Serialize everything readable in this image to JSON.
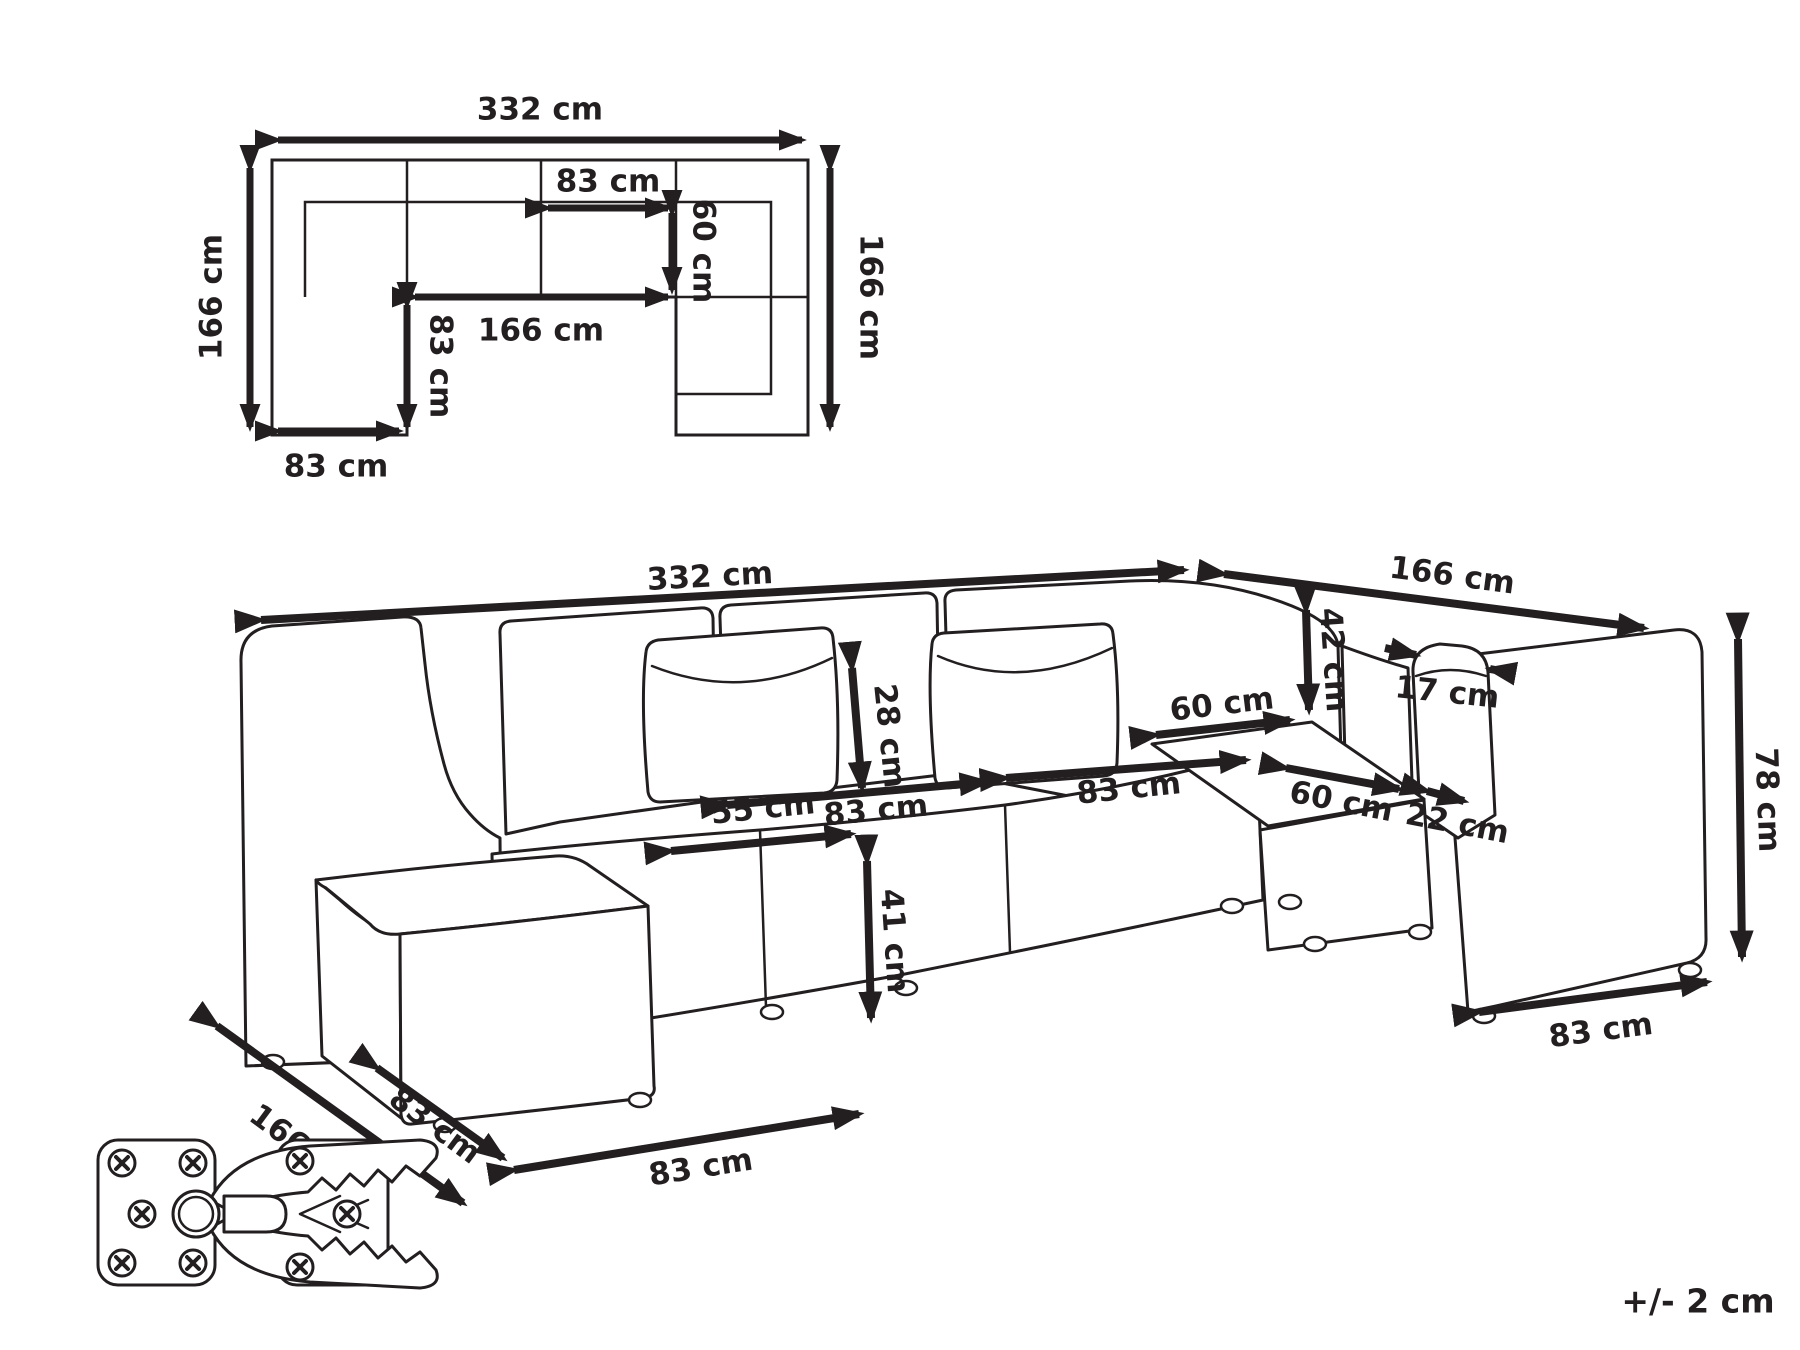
{
  "figure": {
    "type": "modular-corner-sofa-dimension-drawing",
    "line_color": "#231f20",
    "background": "#ffffff",
    "tolerance_note": "+/- 2 cm"
  },
  "plan_view": {
    "dims": {
      "overall_width": "332 cm",
      "left_depth": "166 cm",
      "right_depth": "166 cm",
      "module_width_top": "83 cm",
      "seat_depth": "60 cm",
      "inner_opening_width": "166 cm",
      "chaise_inner_depth": "83 cm",
      "chaise_width": "83 cm"
    }
  },
  "perspective_view": {
    "dims": {
      "total_width": "332 cm",
      "return_length": "166 cm",
      "pillow_height": "28 cm",
      "pillow_width": "55 cm",
      "backrest_height": "42 cm",
      "armrest_top_depth": "17 cm",
      "seat_depth_corner": "60 cm",
      "seat_width_left": "83 cm",
      "seat_width_center": "83 cm",
      "seat_depth_return": "60 cm",
      "armrest_front_width": "22 cm",
      "seat_height": "41 cm",
      "total_height": "78 cm",
      "end_module_bottom_width": "83 cm",
      "side_total_depth": "166 cm",
      "chaise_module_width": "83 cm",
      "chaise_front_width": "83 cm"
    }
  }
}
